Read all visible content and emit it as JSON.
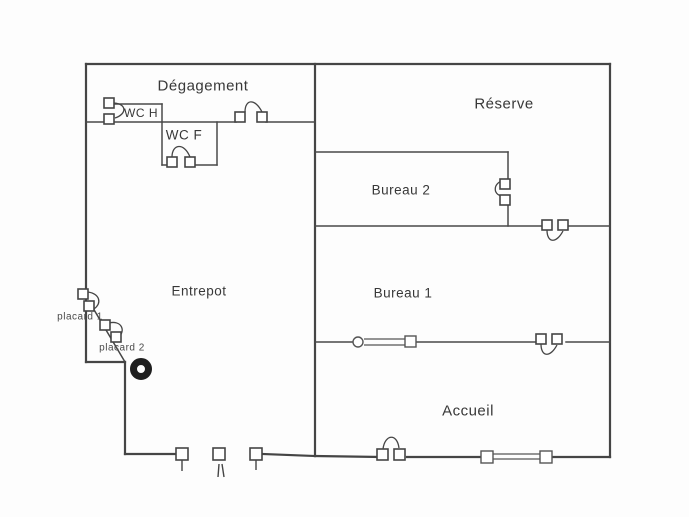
{
  "diagram": {
    "type": "floor-plan",
    "rooms": {
      "degagement": "Dégagement",
      "reserve": "Réserve",
      "wc_h": "WC H",
      "wc_f": "WC F",
      "bureau2": "Bureau 2",
      "bureau1": "Bureau 1",
      "entrepot": "Entrepot",
      "accueil": "Accueil",
      "placard1": "placard 1",
      "placard2": "placard 2"
    },
    "symbols": {
      "door": "quarter-arc-swing-door",
      "window": "double-line-with-end-posts",
      "column": "filled-ring",
      "entrance_posts": "three-square-posts-with-leaf-ticks"
    },
    "colors": {
      "wall": "#454545",
      "text": "#383838",
      "background": "#fdfdfd",
      "column": "#1f1f1f"
    }
  }
}
